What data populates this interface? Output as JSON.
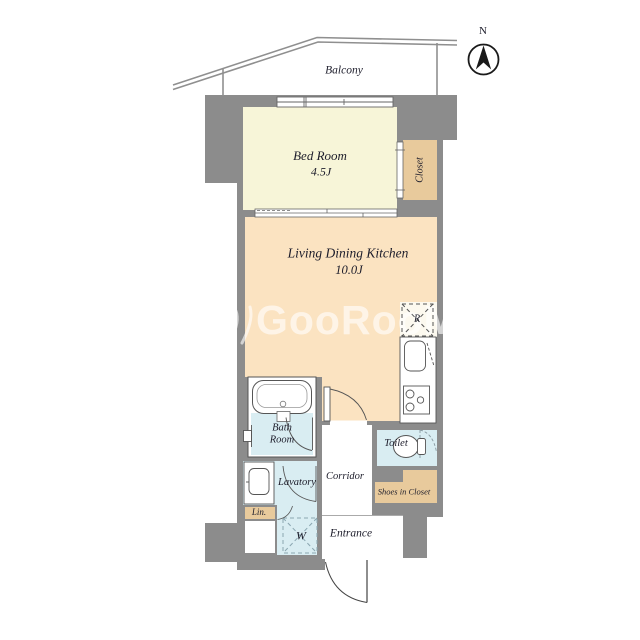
{
  "colors": {
    "wall": "#8c8c8c",
    "bedroom": "#f7f5d8",
    "ldk": "#fbe3c1",
    "tan": "#e8ca9c",
    "wet": "#d9edf2",
    "floor_white": "#ffffff",
    "line": "#555555",
    "text": "#1d1d2b",
    "watermark": "rgba(255,255,255,0.62)"
  },
  "compass": {
    "label": "N"
  },
  "balcony": {
    "label": "Balcony"
  },
  "watermark": {
    "text": "GooRooM"
  },
  "rooms": {
    "bedroom": {
      "label": "Bed Room",
      "size": "4.5J"
    },
    "closet": {
      "label": "Closet"
    },
    "ldk": {
      "label": "Living Dining Kitchen",
      "size": "10.0J"
    },
    "refrigerator": {
      "label": "R"
    },
    "bath": {
      "line1": "Bath",
      "line2": "Room"
    },
    "lavatory": {
      "label": "Lavatory"
    },
    "linen": {
      "label": "Lin."
    },
    "washer": {
      "label": "W"
    },
    "corridor": {
      "label": "Corridor"
    },
    "toilet": {
      "label": "Toilet"
    },
    "shoes_closet": {
      "label": "Shoes in Closet"
    },
    "entrance": {
      "label": "Entrance"
    }
  }
}
